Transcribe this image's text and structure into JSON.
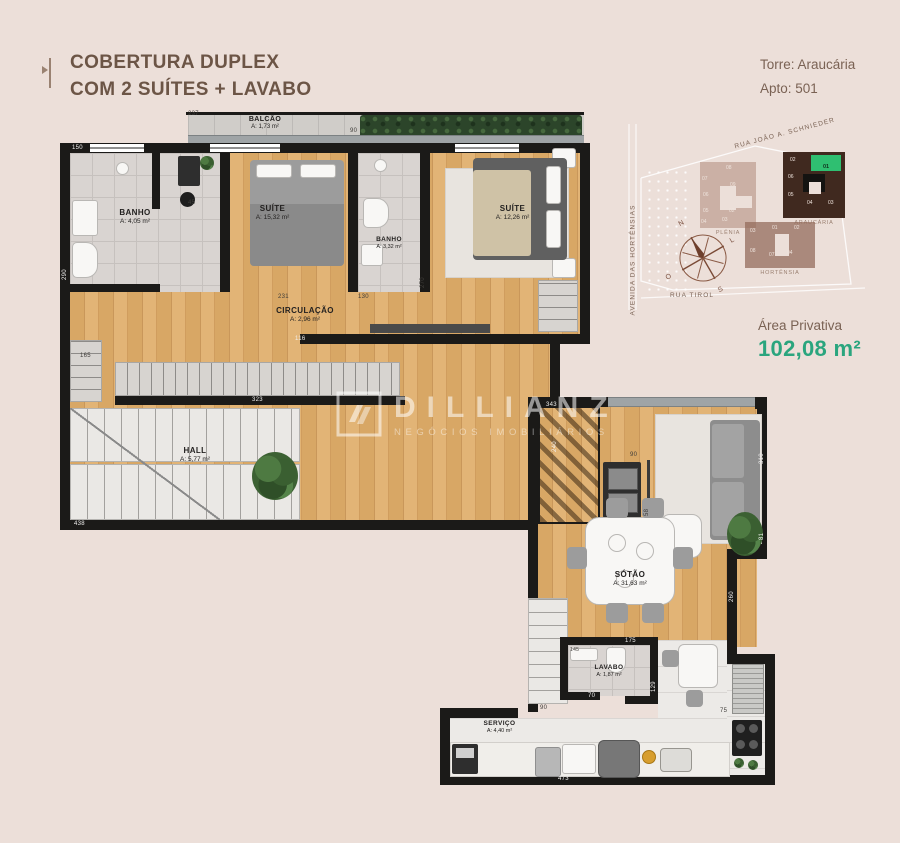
{
  "header": {
    "title_line1": "COBERTURA DUPLEX",
    "title_line2": "COM 2 SUÍTES + LAVABO",
    "tower": "Torre: Araucária",
    "apto": "Apto: 501"
  },
  "area_privativa": {
    "label": "Área Privativa",
    "value": "102,08 m²"
  },
  "watermark": {
    "brand": "DILLIANZ",
    "tagline": "NEGÓCIOS IMOBILIÁRIOS"
  },
  "site_map": {
    "streets": {
      "top": "RUA JOÃO A. SCHNIEDER",
      "left": "AVENIDA DAS HORTÊNSIAS",
      "bottom": "RUA TIROL"
    },
    "compass": {
      "n": "N",
      "e": "L",
      "s": "S",
      "w": "O"
    },
    "highlight_color": "#2fbf71",
    "buildings": [
      {
        "name": "PLÊNIA",
        "units": [
          "07",
          "08",
          "06",
          "09",
          "05",
          "03",
          "04",
          "02"
        ]
      },
      {
        "name": "ARAUCÁRIA",
        "units": [
          "02",
          "01",
          "06",
          "05",
          "04",
          "03"
        ],
        "highlighted_unit": "01"
      },
      {
        "name": "HORTÊNSIA",
        "units": [
          "03",
          "01",
          "02",
          "08",
          "07",
          "04"
        ]
      }
    ]
  },
  "floors": {
    "upper": {
      "rooms": {
        "balcao": {
          "name": "BALCÃO",
          "area": "A: 1,73 m²"
        },
        "banho1": {
          "name": "BANHO",
          "area": "A: 4,05 m²"
        },
        "suite1": {
          "name": "SUÍTE",
          "area": "A: 15,32 m²"
        },
        "banho2": {
          "name": "BANHO",
          "area": "A: 3,32 m²"
        },
        "suite2": {
          "name": "SUÍTE",
          "area": "A: 12,26 m²"
        },
        "circulacao": {
          "name": "CIRCULAÇÃO",
          "area": "A: 2,96 m²"
        },
        "hall": {
          "name": "HALL",
          "area": "A: 5,77 m²"
        }
      },
      "dims": {
        "d1": "237",
        "d2": "150",
        "d3": "290",
        "d4": "45",
        "d5": "165",
        "d6": "323",
        "d7": "438",
        "d8": "231",
        "d9": "130",
        "d10": "270",
        "d11": "240",
        "d12": "116",
        "d13": "343",
        "d14": "90"
      }
    },
    "lower": {
      "rooms": {
        "sotao": {
          "name": "SÓTÃO",
          "area": "A: 31,63 m²"
        },
        "lavabo": {
          "name": "LAVABO",
          "area": "A: 1,87 m²"
        },
        "servico": {
          "name": "SERVIÇO",
          "area": "A: 4,40 m²"
        }
      },
      "dims": {
        "d1": "90",
        "d2": "175",
        "d3": "145",
        "d4": "70",
        "d5": "129",
        "d6": "75",
        "d7": "473",
        "d8": "310",
        "d9": "260",
        "d10": "81",
        "d11": "90",
        "d12": "58"
      }
    }
  }
}
